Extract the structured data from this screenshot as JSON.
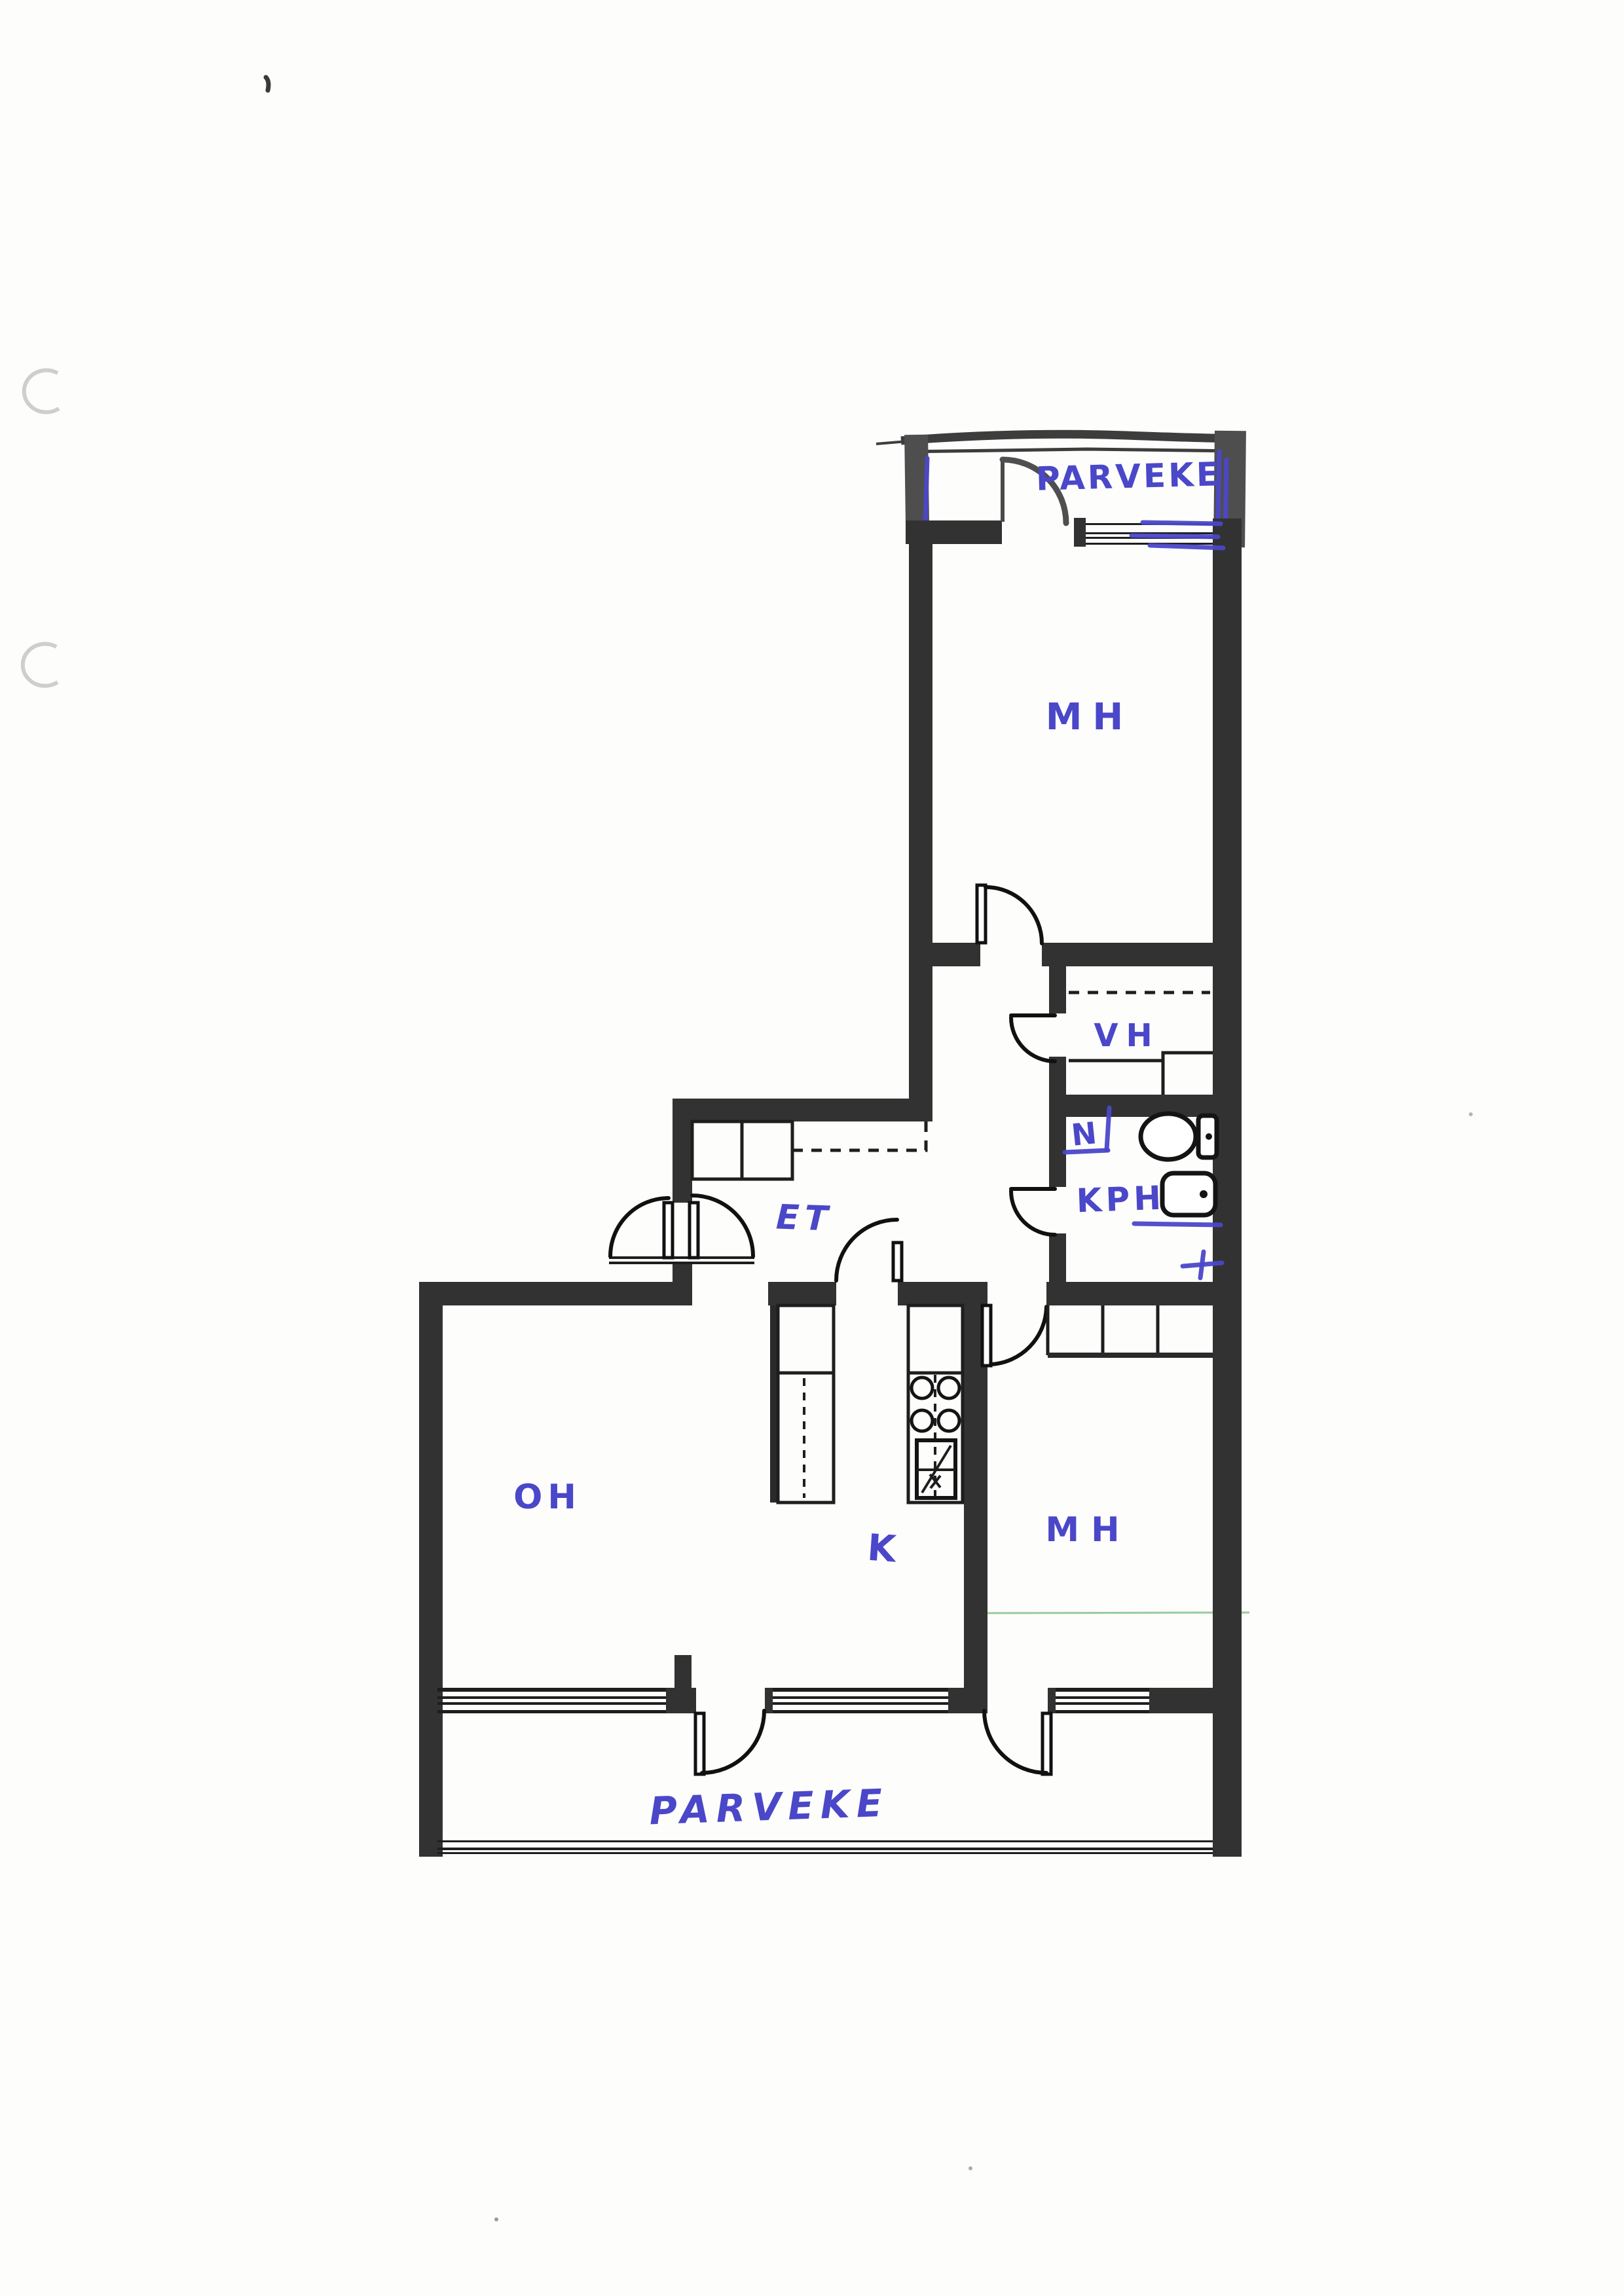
{
  "document": {
    "kind": "scanned hand-annotated floor plan",
    "ink_color": "#4b47c9",
    "wall_color": "#323232",
    "paper_color": "#fdfdfc"
  },
  "rooms": {
    "balcony_top": {
      "label": "PARVEKE"
    },
    "bedroom_top": {
      "label": "MH"
    },
    "closet": {
      "label": "VH"
    },
    "bathroom": {
      "label": "KPH"
    },
    "hallway": {
      "label": "ET"
    },
    "living_room": {
      "label": "OH"
    },
    "kitchen": {
      "label": "K"
    },
    "bedroom_bottom": {
      "label": "MH"
    },
    "balcony_bottom": {
      "label": "PARVEKE"
    }
  },
  "annotations": {
    "bathroom_note": "N"
  },
  "fixtures": [
    {
      "name": "toilet-icon"
    },
    {
      "name": "sink-icon"
    },
    {
      "name": "stove-icon"
    },
    {
      "name": "oven-icon"
    },
    {
      "name": "wardrobe-top-bedroom"
    },
    {
      "name": "wardrobe-hallway"
    },
    {
      "name": "kitchen-counter"
    }
  ]
}
